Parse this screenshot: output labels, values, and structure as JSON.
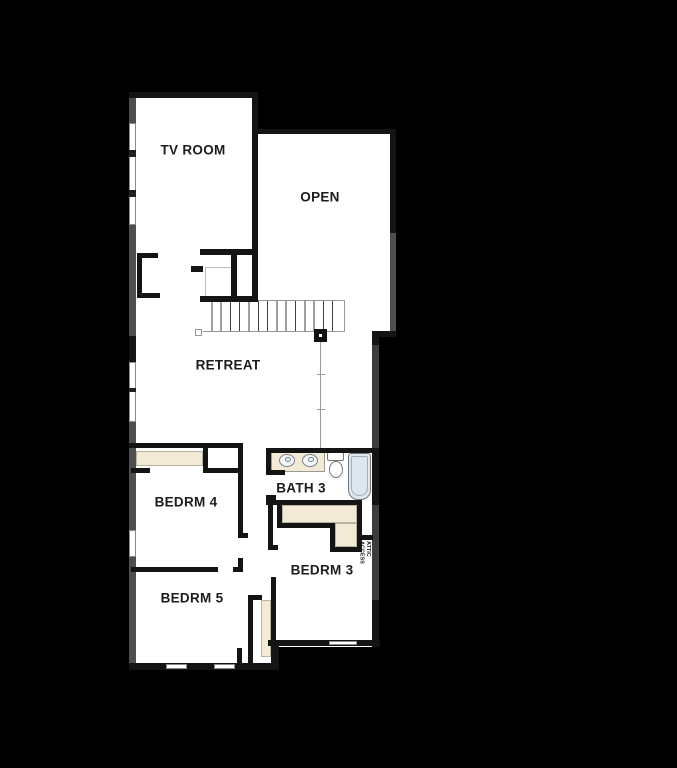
{
  "title": "Second floor plan",
  "colors": {
    "background": "#000000",
    "room_fill": "#ffffff",
    "interior_wall": "#141414",
    "exterior_wall": "#4e4e4e",
    "exterior_wall_dark": "#3c3c3c",
    "window_frame": "#8a8a8a",
    "closet_shelf": "#f3ead6",
    "fixture_fill": "#dce8ee",
    "fixture_stroke": "#77818a",
    "stair_line": "#9a9a9a",
    "label_text": "#1c1c1c"
  },
  "rooms": {
    "tv_room": {
      "label": "TV ROOM"
    },
    "open_below": {
      "label": "OPEN"
    },
    "retreat": {
      "label": "RETREAT"
    },
    "bedroom4": {
      "label": "BEDRM 4"
    },
    "bath3": {
      "label": "BATH 3"
    },
    "bedroom3": {
      "label": "BEDRM 3"
    },
    "bedroom5": {
      "label": "BEDRM 5"
    }
  },
  "annotations": {
    "attic_access": {
      "label": "ATTIC ACCESS"
    }
  },
  "fixtures": {
    "stairs": "staircase-up",
    "bath3": [
      "double-vanity-sinks",
      "toilet",
      "bathtub"
    ]
  }
}
